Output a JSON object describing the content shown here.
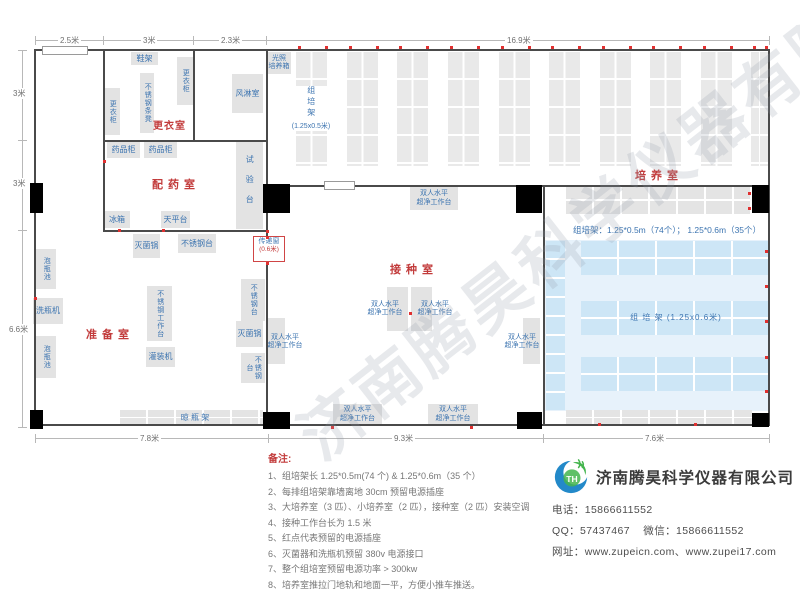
{
  "watermark": "济南腾昊科学仪器有限公司",
  "dims": {
    "top": [
      "2.5米",
      "3米",
      "2.3米",
      "16.9米"
    ],
    "left": [
      "3米",
      "3米",
      "6.6米"
    ],
    "bottom": [
      "7.8米",
      "9.3米",
      "7.6米"
    ]
  },
  "rooms": {
    "changing": "更衣室",
    "dispensing": "配药室",
    "prep": "准备室",
    "inoculation": "接种室",
    "culture": "培养室"
  },
  "equipment": {
    "shoe_rack": "鞋架",
    "locker": "更衣柜",
    "ss_strip_bench": "不锈钢条凳",
    "air_shower": "风淋室",
    "light_incubator_l1": "光照",
    "light_incubator_l2": "培养箱",
    "medicine_cabinet": "药品柜",
    "test_bench": "试验台",
    "fridge": "冰箱",
    "balance": "天平台",
    "sterilizer": "灭菌锅",
    "ss_table": "不锈钢台",
    "transfer_window": "传递窗",
    "transfer_window_size": "(0.6米)",
    "soak_pool": "泡瓶池",
    "bottle_washer": "洗瓶机",
    "ss_workbench": "不锈钢工作台",
    "filler": "灌装机",
    "drying_rack": "晾 瓶 架",
    "clean_bench_l1": "双人水平",
    "clean_bench_l2": "超净工作台",
    "rack_v_name": "组培架",
    "rack_v_size": "(1.25x0.5米)",
    "rack_h_label": "组 培 架 (1.25x0.6米)",
    "rack_spec": "组培架：1.25*0.5m（74个）；  1.25*0.6m（35个）"
  },
  "notes": {
    "title": "备注:",
    "items": [
      "1、组培架长 1.25*0.5m(74 个) & 1.25*0.6m（35 个）",
      "2、每排组培架靠墙离地 30cm 预留电源插座",
      "3、大培养室（3 匹）、小培养室（2 匹），接种室（2 匹）安装空调",
      "4、接种工作台长为 1.5 米",
      "5、红点代表预留的电源插座",
      "6、灭菌器和洗瓶机预留 380v 电源接口",
      "7、整个组培室预留电源功率 > 300kw",
      "8、培养室推拉门地轨和地面一平，方便小推车推送。"
    ]
  },
  "company": {
    "name": "济南腾昊科学仪器有限公司",
    "logo_monogram": "TH",
    "phone_label": "电话：",
    "phone": "15866611552",
    "qq_label": "QQ：",
    "qq": "57437467",
    "wechat_label": "微信：",
    "wechat": "15866611552",
    "web_label": "网址：",
    "url1": "www.zupeicn.com",
    "url_sep": "、",
    "url2": "www.zupei17.com"
  },
  "colors": {
    "accent_red": "#c23b3b",
    "label_blue": "#3c74b0",
    "wall": "#4a4a4a",
    "rack_gray": "#e7e7e7",
    "blue_room_bg": "#e7f2fb",
    "blue_band": "#cde6f6",
    "outlet_dot": "#e03030",
    "logo_blue": "#2389c9",
    "logo_green": "#44b54e"
  }
}
